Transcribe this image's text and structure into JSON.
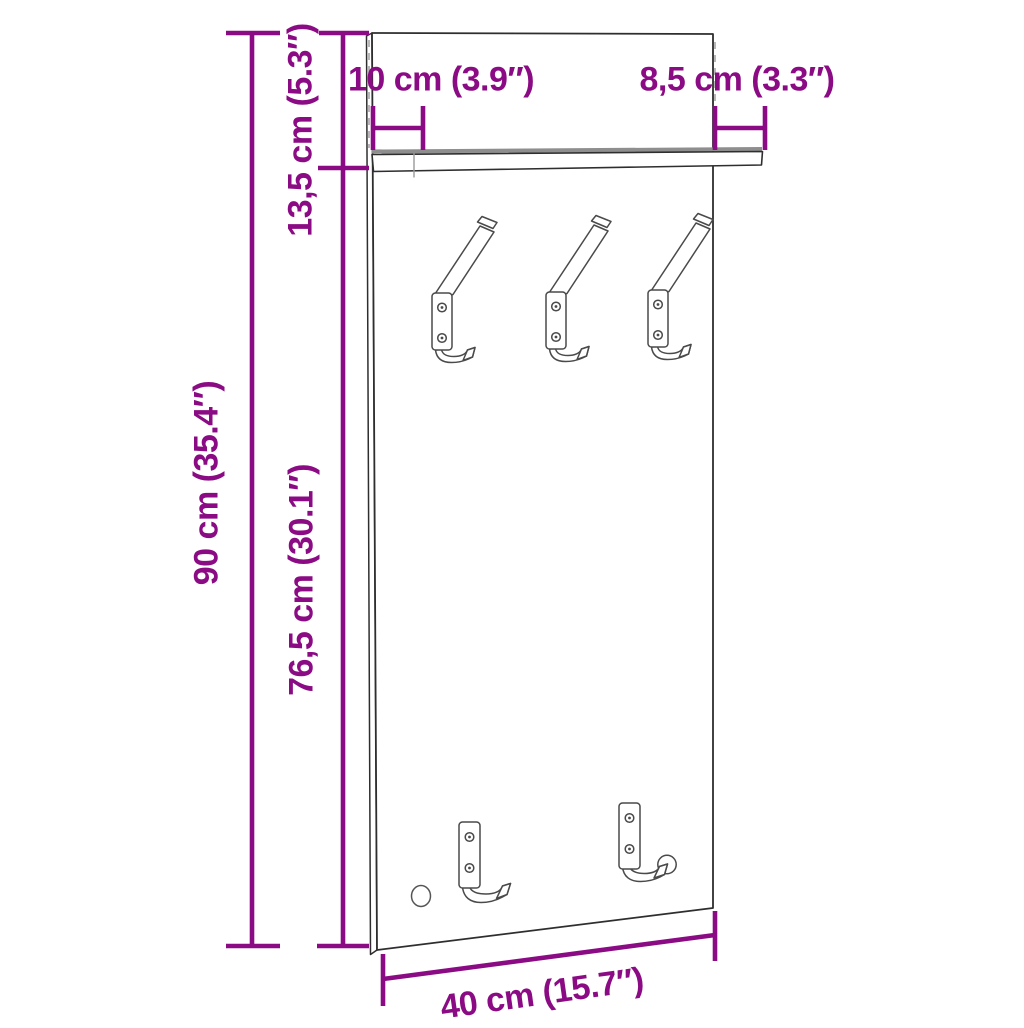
{
  "figure": {
    "type": "product-dimension-diagram",
    "background_color": "#ffffff",
    "accent_color": "#8B0B84",
    "outline_color": "#2e2e2e",
    "secondary_line_color": "#9a9a9a",
    "labels": {
      "total_height": "90 cm (35.4″)",
      "upper_height": "13,5 cm (5.3″)",
      "lower_height": "76,5 cm (30.1″)",
      "bottom_width": "40 cm (15.7″)",
      "shelf_overhang_left": "10 cm (3.9″)",
      "shelf_overhang_right": "8,5 cm (3.3″)"
    }
  }
}
